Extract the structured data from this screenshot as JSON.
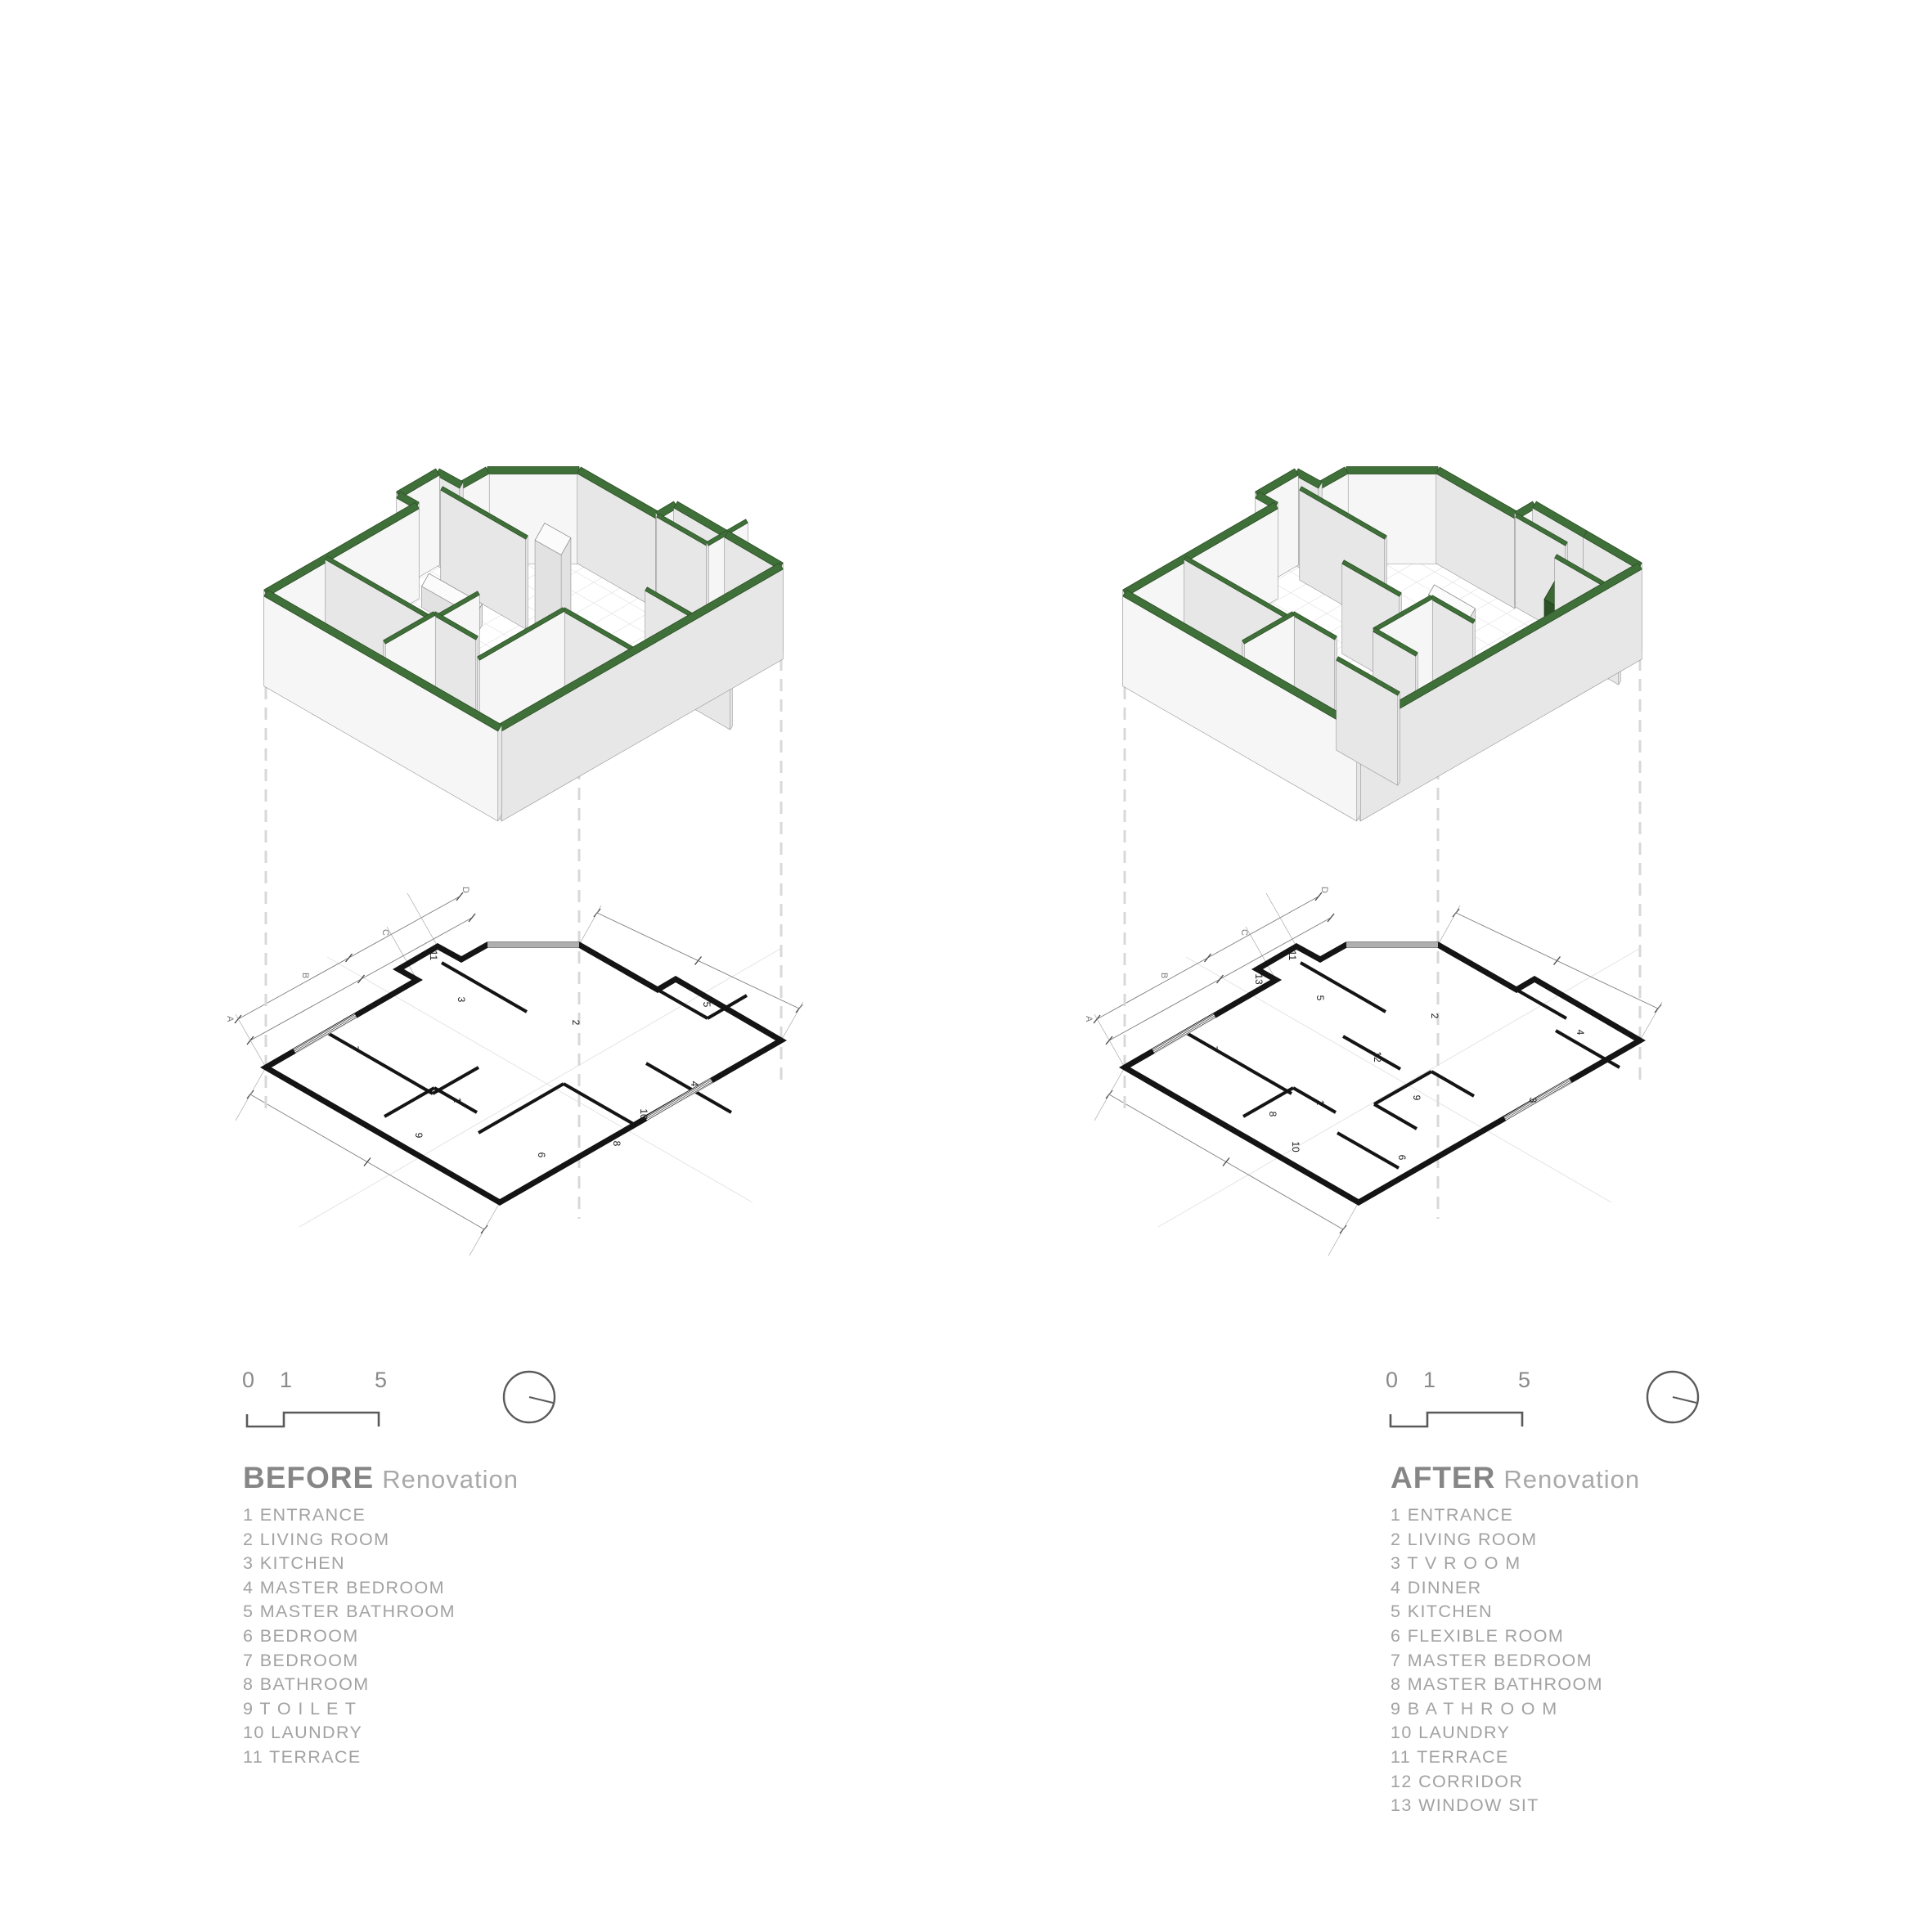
{
  "sheet": {
    "background": "#ffffff"
  },
  "colors": {
    "wall_green": "#40703a",
    "wall_green_dark": "#2a4f22",
    "cabinet_green": "#3c6833",
    "drawing_gray": "#5a5a5a",
    "scale_text_gray": "#8a8a8a",
    "title_gray": "#868686",
    "subtitle_gray": "#a9a9a9",
    "legend_gray": "#a2a2a2",
    "plan_wall_black": "#141414",
    "dash_gray": "#d8d8d8"
  },
  "grid_letters": [
    "A",
    "B",
    "C",
    "D"
  ],
  "panels": [
    {
      "id": "before",
      "title": {
        "strong": "BEFORE",
        "light": "Renovation"
      },
      "scalebar": [
        "0",
        "1",
        "5"
      ],
      "compass": "north-indicator",
      "plan_room_numbers": [
        "1",
        "2",
        "3",
        "4",
        "5",
        "6",
        "7",
        "8",
        "9",
        "10",
        "11"
      ],
      "legend": [
        {
          "num": "1",
          "label": "ENTRANCE"
        },
        {
          "num": "2",
          "label": "LIVING ROOM"
        },
        {
          "num": "3",
          "label": "KITCHEN"
        },
        {
          "num": "4",
          "label": "MASTER BEDROOM"
        },
        {
          "num": "5",
          "label": "MASTER BATHROOM"
        },
        {
          "num": "6",
          "label": "BEDROOM"
        },
        {
          "num": "7",
          "label": "BEDROOM"
        },
        {
          "num": "8",
          "label": "BATHROOM"
        },
        {
          "num": "9",
          "label": "T O I L E T"
        },
        {
          "num": "10",
          "label": "LAUNDRY"
        },
        {
          "num": "11",
          "label": "TERRACE"
        }
      ]
    },
    {
      "id": "after",
      "title": {
        "strong": "AFTER",
        "light": "Renovation"
      },
      "scalebar": [
        "0",
        "1",
        "5"
      ],
      "compass": "north-indicator",
      "plan_room_numbers": [
        "1",
        "2",
        "3",
        "4",
        "5",
        "6",
        "7",
        "8",
        "9",
        "10",
        "11",
        "12",
        "13"
      ],
      "legend": [
        {
          "num": "1",
          "label": "ENTRANCE"
        },
        {
          "num": "2",
          "label": "LIVING ROOM"
        },
        {
          "num": "3",
          "label": "T V R O O M"
        },
        {
          "num": "4",
          "label": "DINNER"
        },
        {
          "num": "5",
          "label": "KITCHEN"
        },
        {
          "num": "6",
          "label": "FLEXIBLE ROOM"
        },
        {
          "num": "7",
          "label": "MASTER BEDROOM"
        },
        {
          "num": "8",
          "label": "MASTER BATHROOM"
        },
        {
          "num": "9",
          "label": "B A T H R O O M"
        },
        {
          "num": "10",
          "label": "LAUNDRY"
        },
        {
          "num": "11",
          "label": "TERRACE"
        },
        {
          "num": "12",
          "label": "CORRIDOR"
        },
        {
          "num": "13",
          "label": "WINDOW SIT"
        }
      ]
    }
  ]
}
